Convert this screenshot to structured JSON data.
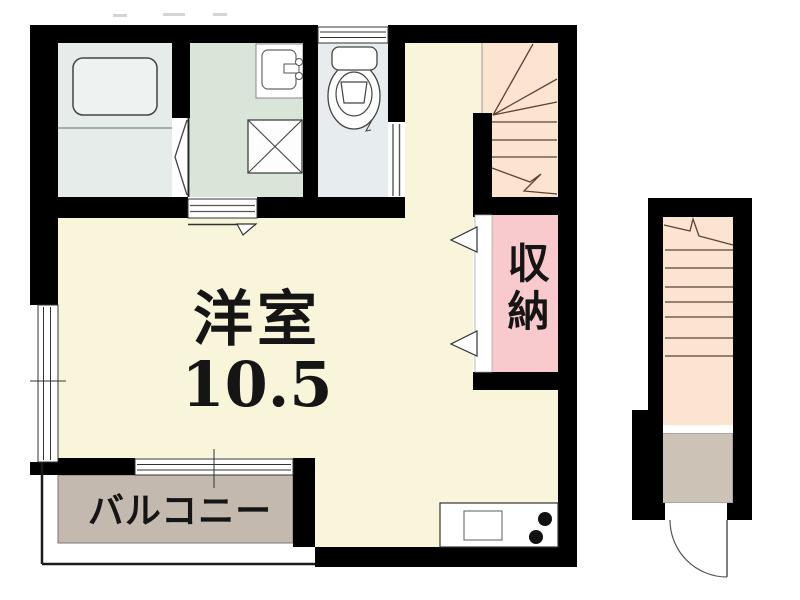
{
  "labels": {
    "main_room": "洋室",
    "main_room_size": "10.5",
    "storage": "収納",
    "balcony": "バルコニー"
  },
  "rooms": [
    {
      "name": "main-room",
      "label": "洋室 10.5"
    },
    {
      "name": "storage-closet",
      "label": "収納"
    },
    {
      "name": "balcony",
      "label": "バルコニー"
    },
    {
      "name": "bathroom",
      "label": ""
    },
    {
      "name": "washroom",
      "label": ""
    },
    {
      "name": "toilet-room",
      "label": ""
    },
    {
      "name": "indoor-stairs",
      "label": ""
    },
    {
      "name": "outdoor-stairs",
      "label": ""
    }
  ],
  "colors": {
    "wall": "#000000",
    "room-cream": "#f8f5da",
    "stairs-peach": "#fbe5d1",
    "storage-pink": "#f8c9cd",
    "balcony-gray": "#c3b9ae",
    "landing-gray": "#cdc2b6",
    "bath-blue": "#e6ecea",
    "tub-fill": "#eef3f1",
    "wash-green": "#d9e5d9",
    "toilet-blue": "#e7edee",
    "stair-line": "#5a4332",
    "fixture-line": "#444444",
    "thin-line": "#333333",
    "label-ink": "#151515"
  }
}
